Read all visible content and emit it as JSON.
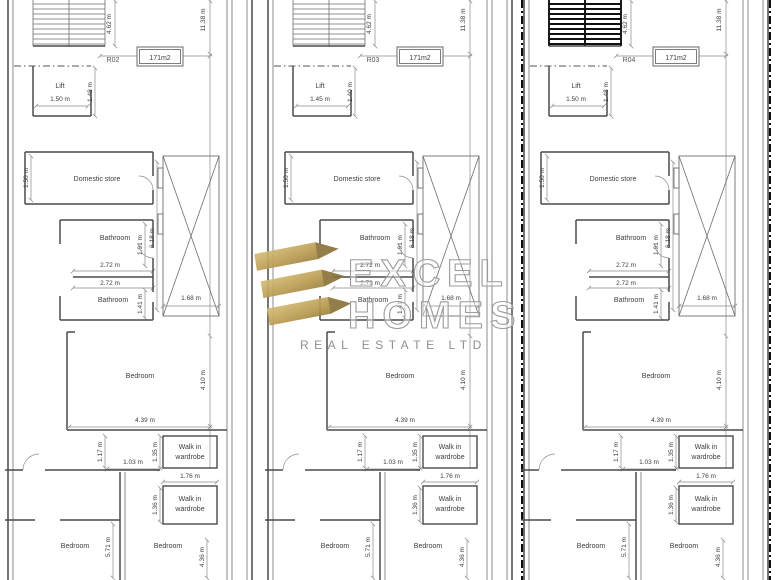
{
  "page": {
    "background": "#ffffff",
    "line_color": "#4a4a4a"
  },
  "watermark": {
    "brand_line1": "EXCEL",
    "brand_line2": "HOMES",
    "brand_line3": "REAL ESTATE LTD",
    "gold": "#c3a85e",
    "gold_dark": "#8a7339"
  },
  "plans": [
    {
      "room_no": "R02",
      "area": "171m2",
      "lift": {
        "label": "Lift",
        "width": "1.50 m",
        "depth": "1.48 m"
      },
      "rooms": {
        "domestic_store": "Domestic store",
        "bathroom1": "Bathroom",
        "bathroom2": "Bathroom",
        "bedroom_main": "Bedroom",
        "walk_in": "Walk in",
        "wardrobe": "wardrobe",
        "bedroom_bl": "Bedroom",
        "bedroom_br": "Bedroom"
      },
      "dims": {
        "top_width": "3.88 m",
        "total_height": "11.38 m",
        "stairs_height": "4.62 m",
        "store_depth": "1.50 m",
        "shaft_height": "6.18 m",
        "shaft_width": "1.68 m",
        "bath1_depth": "1.91 m",
        "bath_width_a": "2.72 m",
        "bath_width_b": "2.72 m",
        "bath2_depth": "1.41 m",
        "bedroom_depth": "4.10 m",
        "bedroom_width": "4.39 m",
        "wardrobe1_depth": "1.35 m",
        "hall_depth": "1.17 m",
        "hall_width": "1.03 m",
        "wardrobe_width": "1.76 m",
        "wardrobe2_depth": "1.36 m",
        "bedroom_bl_height": "5.71 m",
        "bedroom_br_height": "4.36 m"
      }
    },
    {
      "room_no": "R03",
      "area": "171m2",
      "lift": {
        "label": "Lift",
        "width": "1.45 m",
        "depth": "1.40 m"
      },
      "rooms": {
        "domestic_store": "Domestic store",
        "bathroom1": "Bathroom",
        "bathroom2": "Bathroom",
        "bedroom_main": "Bedroom",
        "walk_in": "Walk in",
        "wardrobe": "wardrobe",
        "bedroom_bl": "Bedroom",
        "bedroom_br": "Bedroom"
      },
      "dims": {
        "top_width": "3.88 m",
        "total_height": "11.38 m",
        "stairs_height": "4.62 m",
        "store_depth": "1.50 m",
        "shaft_height": "6.18 m",
        "shaft_width": "1.68 m",
        "bath1_depth": "1.91 m",
        "bath_width_a": "2.72 m",
        "bath_width_b": "2.72 m",
        "bath2_depth": "1.41 m",
        "bedroom_depth": "4.10 m",
        "bedroom_width": "4.39 m",
        "wardrobe1_depth": "1.35 m",
        "hall_depth": "1.17 m",
        "hall_width": "1.03 m",
        "wardrobe_width": "1.76 m",
        "wardrobe2_depth": "1.36 m",
        "bedroom_bl_height": "5.71 m",
        "bedroom_br_height": "4.36 m"
      }
    },
    {
      "room_no": "R04",
      "area": "171m2",
      "lift": {
        "label": "Lift",
        "width": "1.50 m",
        "depth": "1.48 m"
      },
      "rooms": {
        "domestic_store": "Domestic store",
        "bathroom1": "Bathroom",
        "bathroom2": "Bathroom",
        "bedroom_main": "Bedroom",
        "walk_in": "Walk in",
        "wardrobe": "wardrobe",
        "bedroom_bl": "Bedroom",
        "bedroom_br": "Bedroom"
      },
      "dims": {
        "top_width": "3.88 m",
        "total_height": "11.38 m",
        "stairs_height": "4.62 m",
        "store_depth": "1.50 m",
        "shaft_height": "6.18 m",
        "shaft_width": "1.68 m",
        "bath1_depth": "1.91 m",
        "bath_width_a": "2.72 m",
        "bath_width_b": "2.72 m",
        "bath2_depth": "1.41 m",
        "bedroom_depth": "4.10 m",
        "bedroom_width": "4.39 m",
        "wardrobe1_depth": "1.35 m",
        "hall_depth": "1.17 m",
        "hall_width": "1.03 m",
        "wardrobe_width": "1.76 m",
        "wardrobe2_depth": "1.36 m",
        "bedroom_bl_height": "5.71 m",
        "bedroom_br_height": "4.36 m"
      }
    }
  ]
}
